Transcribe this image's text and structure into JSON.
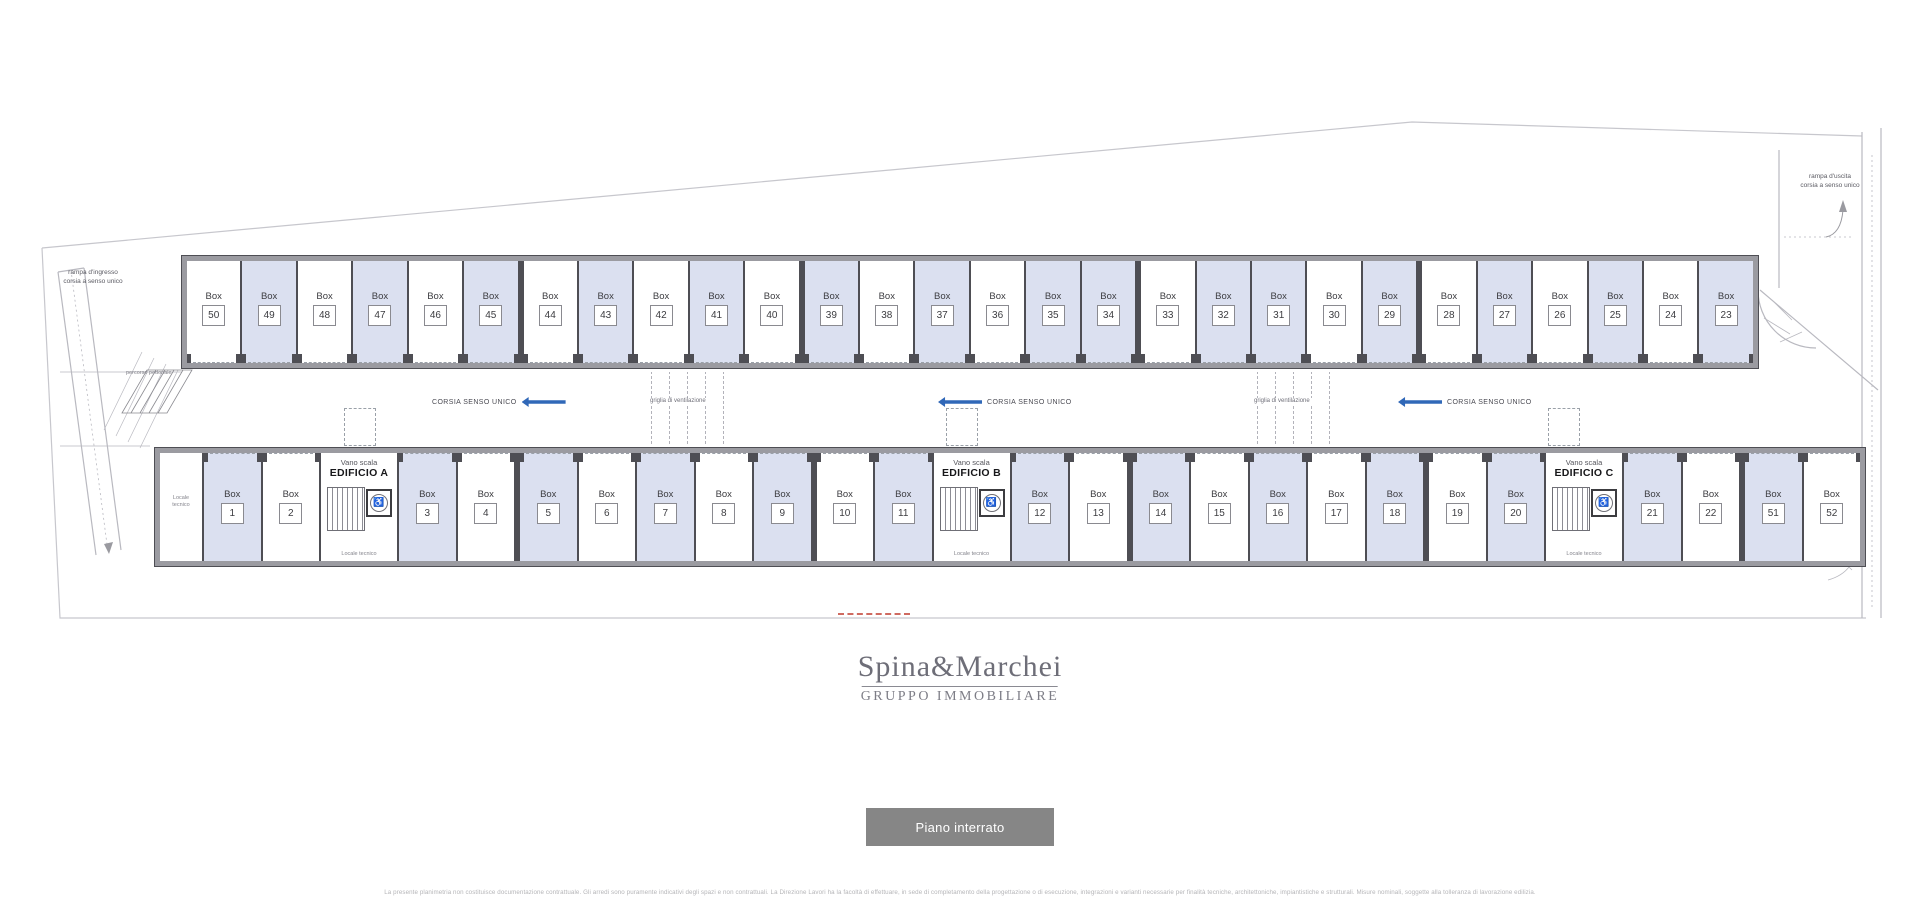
{
  "colors": {
    "box_shaded": "#dbe0f0",
    "wall_dark": "#4e4e54",
    "wall_gray": "#9b9ba1",
    "arrow_blue": "#3068b8",
    "line_light": "#c7c7cd",
    "red_accent": "#c0392b",
    "logo_gray": "#6e6e78",
    "button_bg": "#868686",
    "button_text": "#ffffff",
    "disclaimer_gray": "#b5b5b8",
    "plan_text": "#3c3c40"
  },
  "plan": {
    "labels": {
      "box_word": "Box",
      "corridor": "CORSIA SENSO UNICO",
      "vent": "griglia di ventilazione",
      "stair_small": "Vano scala",
      "tech_room": "Locale tecnico",
      "pedestrian": "percorso pedonale",
      "ramp_in_line1": "rampa d'ingresso",
      "ramp_in_line2": "corsia a senso unico",
      "ramp_out_line1": "rampa d'uscita",
      "ramp_out_line2": "corsia a senso unico"
    },
    "top_row": [
      {
        "num": "50",
        "shaded": false
      },
      {
        "num": "49",
        "shaded": true
      },
      {
        "num": "48",
        "shaded": false
      },
      {
        "num": "47",
        "shaded": true
      },
      {
        "num": "46",
        "shaded": false
      },
      {
        "num": "45",
        "shaded": true
      },
      {
        "num": "44",
        "shaded": false,
        "thick": true
      },
      {
        "num": "43",
        "shaded": true
      },
      {
        "num": "42",
        "shaded": false
      },
      {
        "num": "41",
        "shaded": true
      },
      {
        "num": "40",
        "shaded": false
      },
      {
        "num": "39",
        "shaded": true,
        "thick": true
      },
      {
        "num": "38",
        "shaded": false
      },
      {
        "num": "37",
        "shaded": true
      },
      {
        "num": "36",
        "shaded": false
      },
      {
        "num": "35",
        "shaded": true
      },
      {
        "num": "34",
        "shaded": true
      },
      {
        "num": "33",
        "shaded": false,
        "thick": true
      },
      {
        "num": "32",
        "shaded": true
      },
      {
        "num": "31",
        "shaded": true
      },
      {
        "num": "30",
        "shaded": false
      },
      {
        "num": "29",
        "shaded": true
      },
      {
        "num": "28",
        "shaded": false,
        "thick": true
      },
      {
        "num": "27",
        "shaded": true
      },
      {
        "num": "26",
        "shaded": false
      },
      {
        "num": "25",
        "shaded": true
      },
      {
        "num": "24",
        "shaded": false
      },
      {
        "num": "23",
        "shaded": true
      }
    ],
    "bottom_row": [
      {
        "type": "tech"
      },
      {
        "type": "box",
        "num": "1",
        "shaded": true
      },
      {
        "type": "box",
        "num": "2",
        "shaded": false
      },
      {
        "type": "stair",
        "building": "EDIFICIO A"
      },
      {
        "type": "box",
        "num": "3",
        "shaded": true
      },
      {
        "type": "box",
        "num": "4",
        "shaded": false
      },
      {
        "type": "box",
        "num": "5",
        "shaded": true,
        "thick": true
      },
      {
        "type": "box",
        "num": "6",
        "shaded": false
      },
      {
        "type": "box",
        "num": "7",
        "shaded": true
      },
      {
        "type": "box",
        "num": "8",
        "shaded": false
      },
      {
        "type": "box",
        "num": "9",
        "shaded": true
      },
      {
        "type": "box",
        "num": "10",
        "shaded": false,
        "thick": true
      },
      {
        "type": "box",
        "num": "11",
        "shaded": true
      },
      {
        "type": "stair",
        "building": "EDIFICIO B"
      },
      {
        "type": "box",
        "num": "12",
        "shaded": true
      },
      {
        "type": "box",
        "num": "13",
        "shaded": false
      },
      {
        "type": "box",
        "num": "14",
        "shaded": true,
        "thick": true
      },
      {
        "type": "box",
        "num": "15",
        "shaded": false
      },
      {
        "type": "box",
        "num": "16",
        "shaded": true
      },
      {
        "type": "box",
        "num": "17",
        "shaded": false
      },
      {
        "type": "box",
        "num": "18",
        "shaded": true
      },
      {
        "type": "box",
        "num": "19",
        "shaded": false,
        "thick": true
      },
      {
        "type": "box",
        "num": "20",
        "shaded": true
      },
      {
        "type": "stair",
        "building": "EDIFICIO C"
      },
      {
        "type": "box",
        "num": "21",
        "shaded": true
      },
      {
        "type": "box",
        "num": "22",
        "shaded": false
      },
      {
        "type": "box",
        "num": "51",
        "shaded": true,
        "thick": true
      },
      {
        "type": "box",
        "num": "52",
        "shaded": false
      }
    ]
  },
  "logo": {
    "name": "Spina&Marchei",
    "subtitle": "GRUPPO IMMOBILIARE"
  },
  "button": {
    "label": "Piano interrato"
  },
  "disclaimer": "La presente planimetria non costituisce documentazione contrattuale. Gli arredi sono puramente indicativi degli spazi e non contrattuali. La Direzione Lavori ha la facoltà di effettuare, in sede di completamento della progettazione o di esecuzione, integrazioni e varianti necessarie per finalità tecniche, architettoniche, impiantistiche e strutturali. Misure nominali, soggette alla tolleranza di lavorazione edilizia."
}
